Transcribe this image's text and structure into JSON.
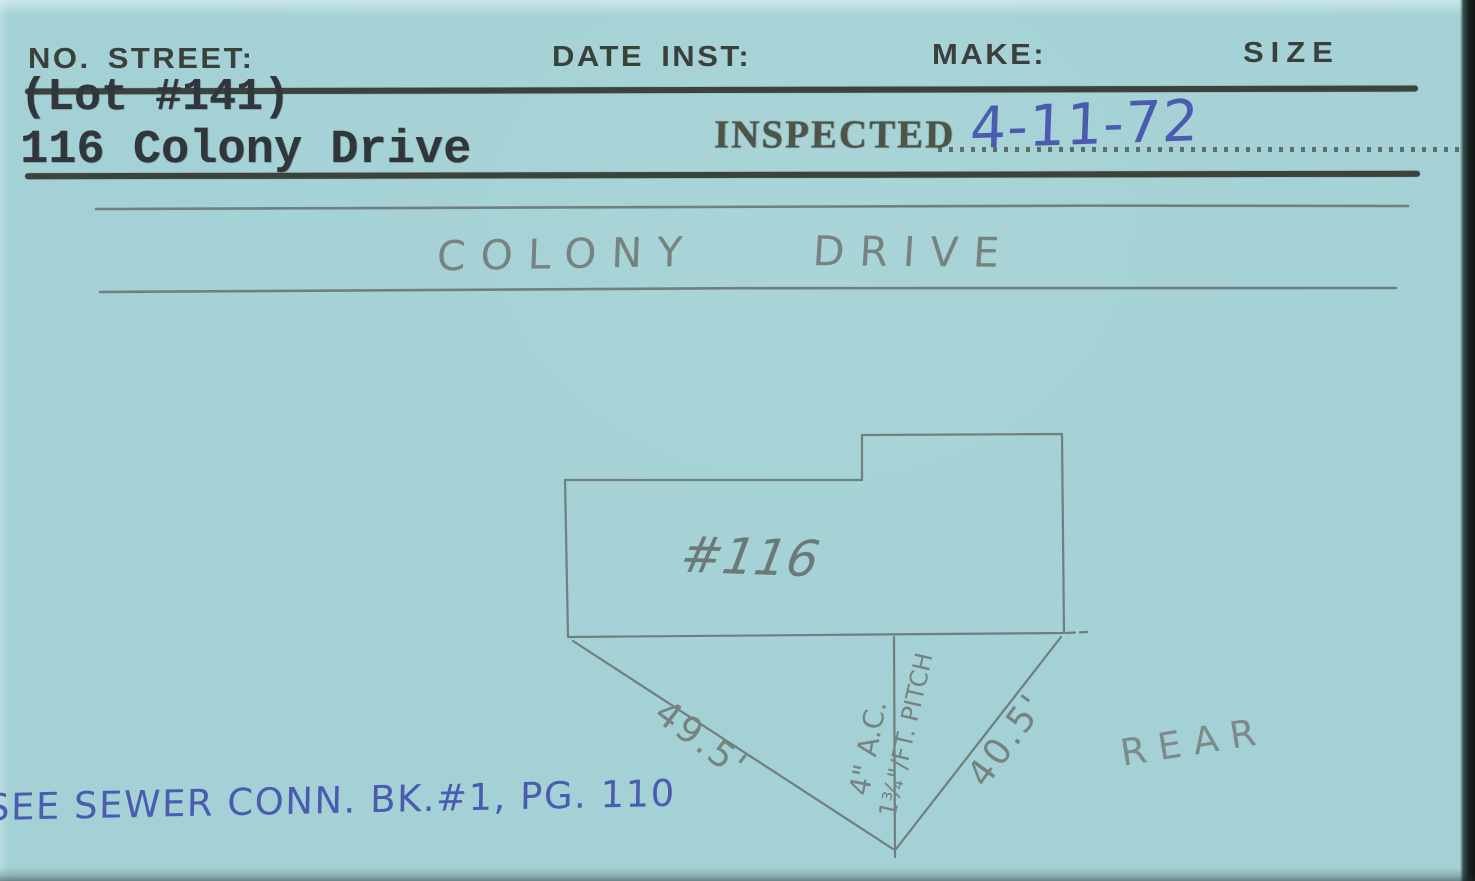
{
  "card": {
    "columns": {
      "no_street": "NO. STREET:",
      "date_inst": "DATE INST:",
      "make": "MAKE:",
      "size": "SIZE"
    },
    "typed": {
      "lot": "(Lot #141)",
      "address": "116 Colony Drive"
    },
    "inspection": {
      "stamp": "INSPECTED",
      "date": "4-11-72"
    },
    "street": {
      "word1": "COLONY",
      "word2": "DRIVE"
    },
    "diagram": {
      "house_number": "#116",
      "left_dimension": "49.5'",
      "right_dimension": "40.5'",
      "pipe_size": "4\" A.C.",
      "pipe_pitch": "1¾\"/FT. PITCH",
      "rear": "REAR"
    },
    "note": "SEE SEWER CONN. BK.#1, PG. 110",
    "colors": {
      "card_background": "#a3d1d5",
      "printed_ink": "#3a403a",
      "typewriter_ink": "#30363a",
      "stamp_ink": "#4d5549",
      "pencil_gray": "#76837f",
      "ballpoint_blue": "#4b5cb0",
      "scan_edge_black": "#0d1210"
    }
  }
}
